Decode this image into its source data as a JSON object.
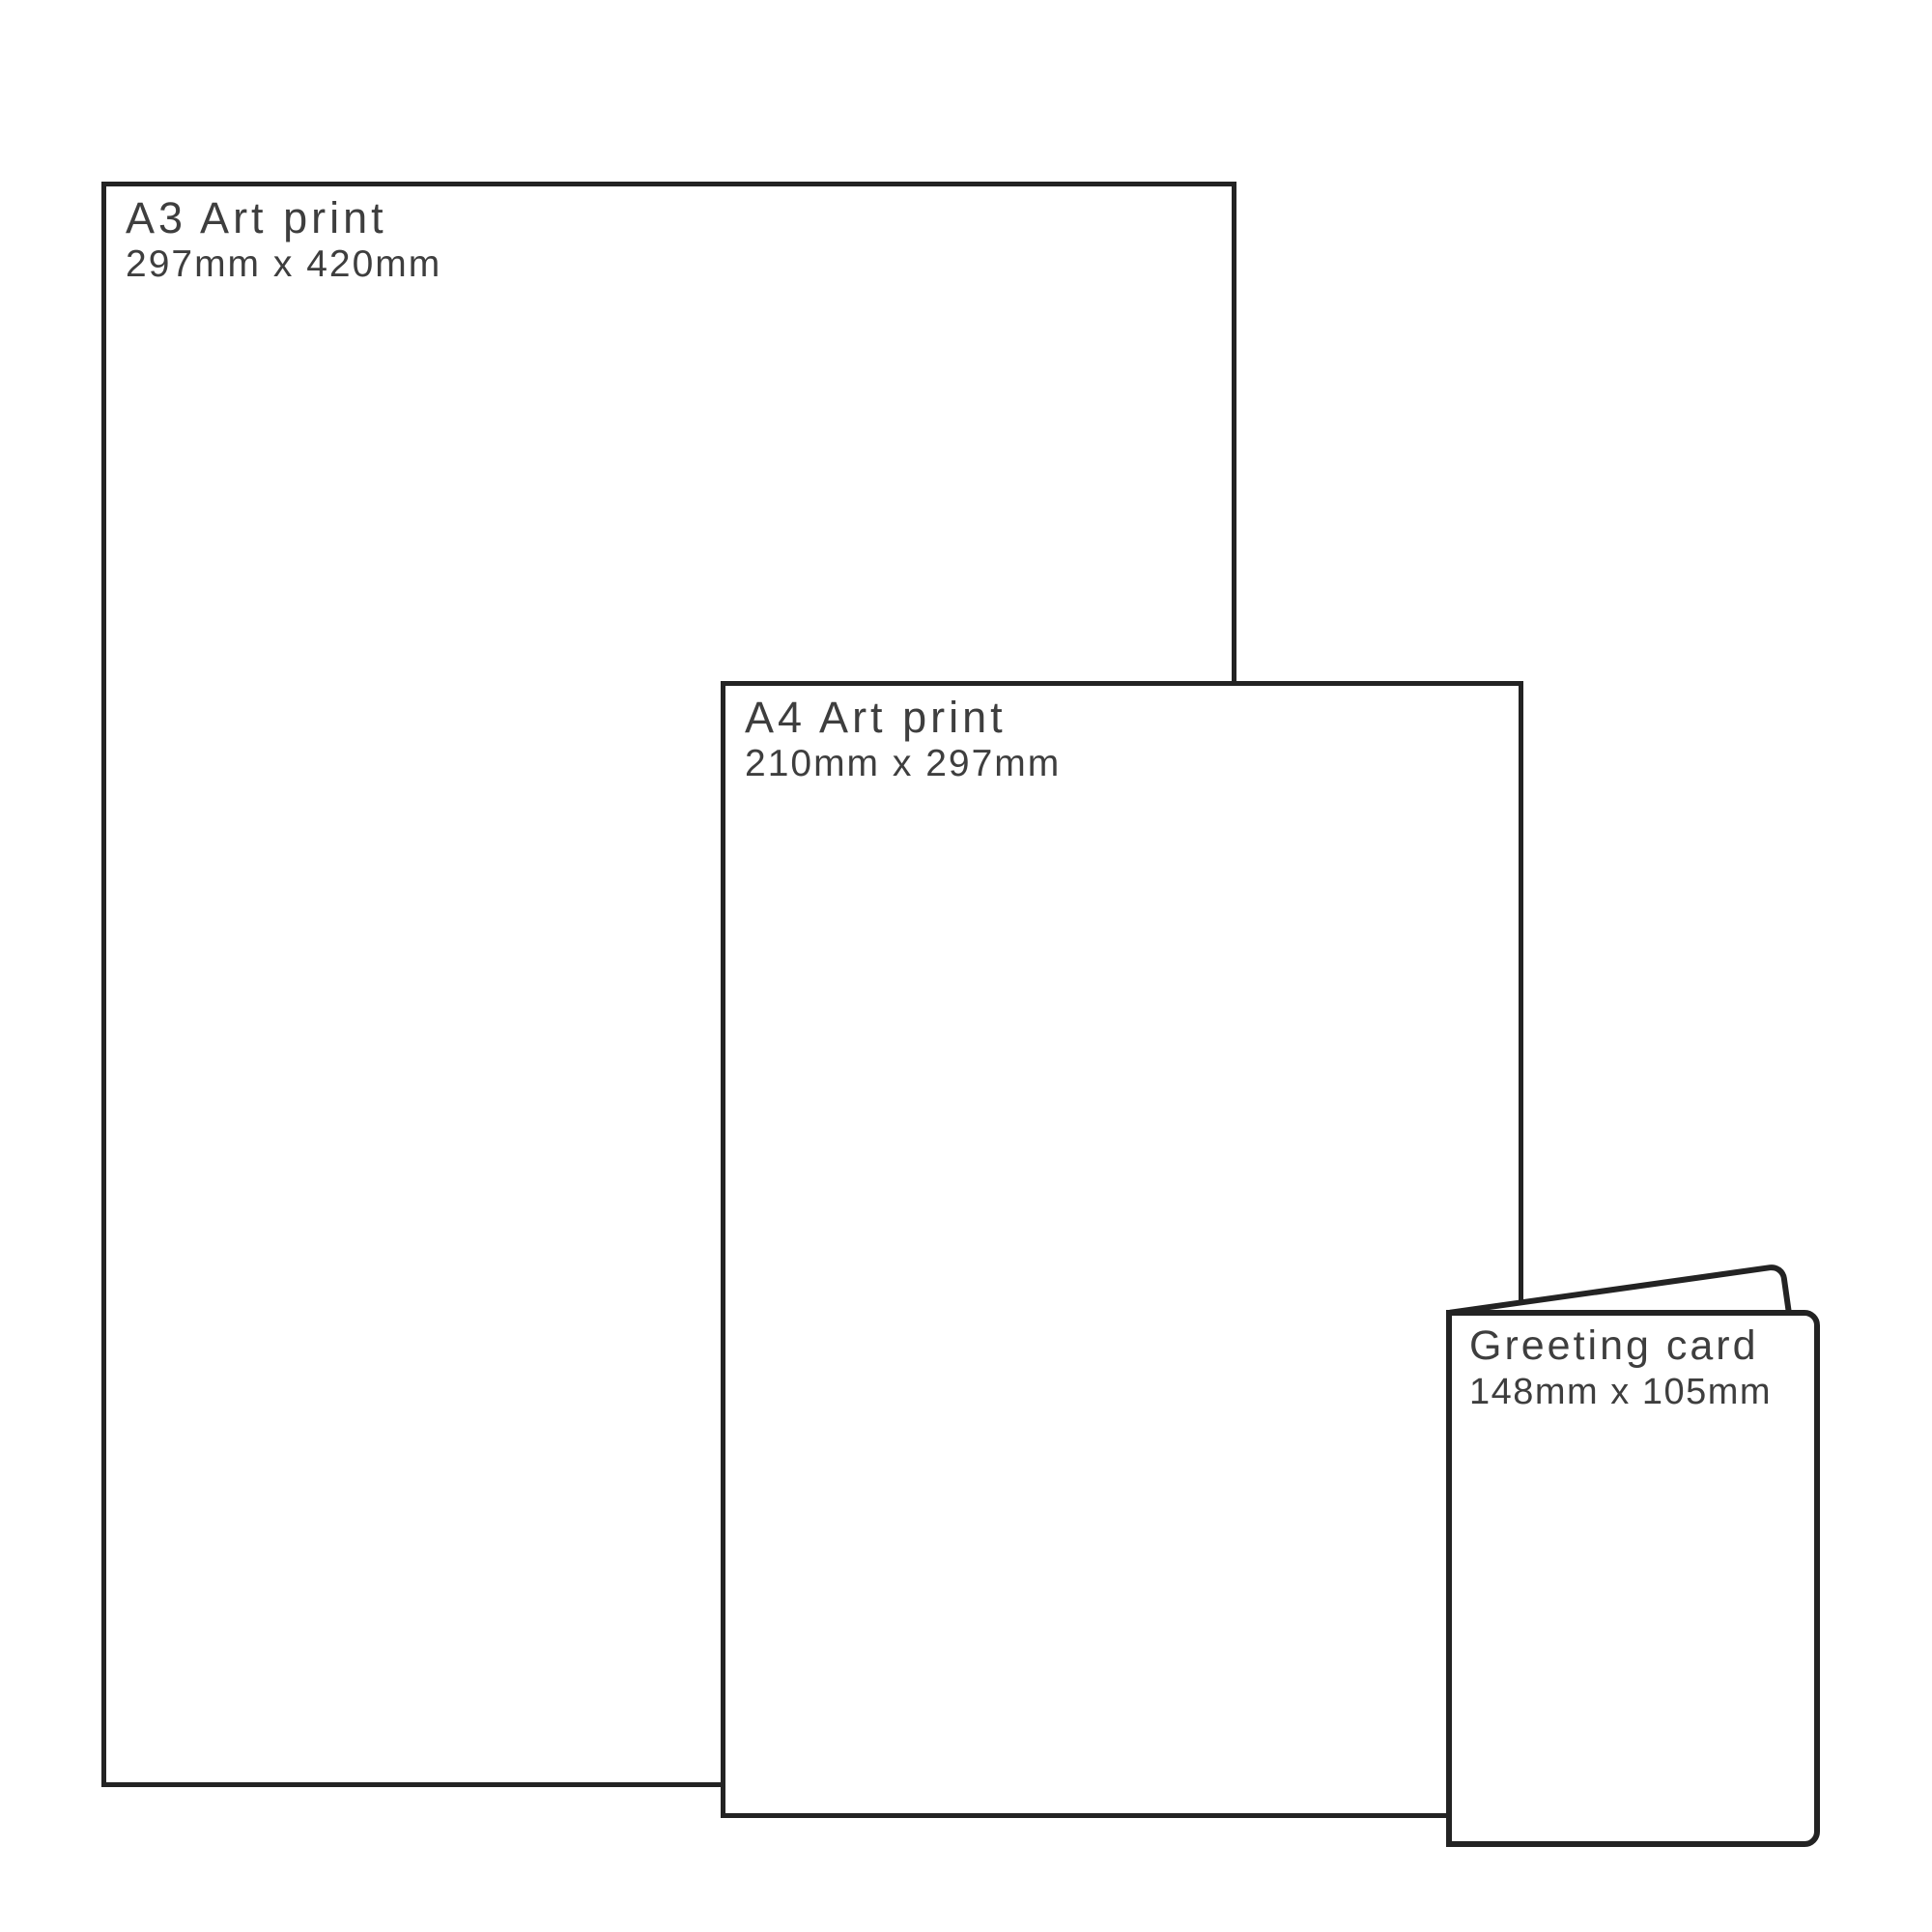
{
  "page": {
    "background_color": "#ffffff",
    "stroke_color": "#232323",
    "text_color": "#3e3e3e",
    "description": "Print size comparison diagram"
  },
  "items": [
    {
      "id": "a3-art-print",
      "title": "A3 Art print",
      "dimensions": "297mm x 420mm"
    },
    {
      "id": "a4-art-print",
      "title": "A4 Art print",
      "dimensions": "210mm x 297mm"
    },
    {
      "id": "greeting-card",
      "title": "Greeting card",
      "dimensions": "148mm x 105mm"
    }
  ]
}
